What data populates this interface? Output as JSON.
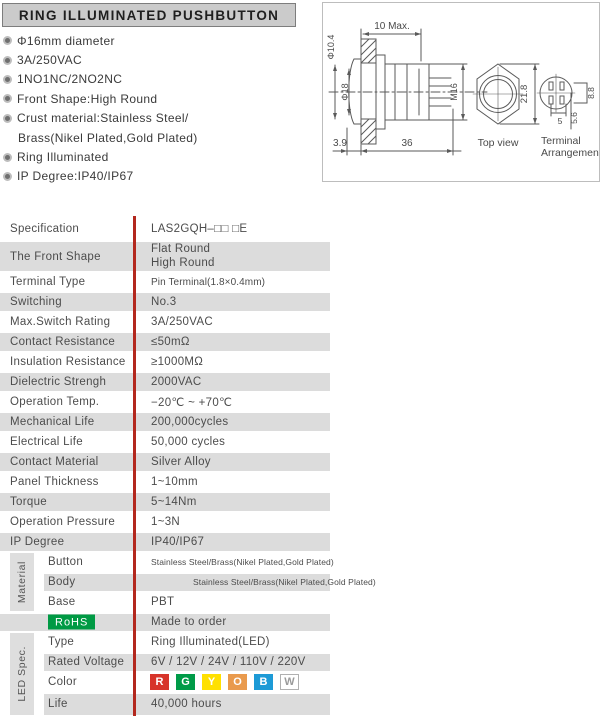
{
  "header": {
    "title": "RING ILLUMINATED PUSHBUTTON"
  },
  "features": {
    "f0": "Φ16mm diameter",
    "f1": "3A/250VAC",
    "f2": "1NO1NC/2NO2NC",
    "f3": "Front Shape:High Round",
    "f4": "Crust material:Stainless Steel/",
    "f4b": "Brass(Nikel Plated,Gold Plated)",
    "f5": "Ring Illuminated",
    "f6": "IP Degree:IP40/IP67"
  },
  "drawing": {
    "dims": {
      "dia_10_4": "Φ10.4",
      "dia_18": "Φ18",
      "panel_max": "10 Max.",
      "thread": "M16",
      "front": "3.9",
      "length": "36",
      "hex": "21.8",
      "term_w": "8.8",
      "term_p": "5.6",
      "term_s": "5"
    },
    "captions": {
      "top_view": "Top view",
      "terminal1": "Terminal",
      "terminal2": "Arrangement"
    }
  },
  "table": {
    "simple_rows": [
      {
        "label": "Specification",
        "value": "LAS2GQH–□□ □E"
      },
      {
        "label": "The Front Shape",
        "value": "Flat Round",
        "value2": "High Round"
      },
      {
        "label": "Terminal Type",
        "value": "Pin Terminal(1.8×0.4mm)"
      },
      {
        "label": "Switching",
        "value": "No.3"
      },
      {
        "label": "Max.Switch Rating",
        "value": "3A/250VAC"
      },
      {
        "label": "Contact Resistance",
        "value": "≤50mΩ"
      },
      {
        "label": "Insulation Resistance",
        "value": "≥1000MΩ"
      },
      {
        "label": "Dielectric Strengh",
        "value": "2000VAC"
      },
      {
        "label": "Operation Temp.",
        "value": "−20℃ ~ +70℃"
      },
      {
        "label": "Mechanical Life",
        "value": "200,000cycles"
      },
      {
        "label": "Electrical Life",
        "value": "50,000 cycles"
      },
      {
        "label": "Contact Material",
        "value": "Silver Alloy"
      },
      {
        "label": "Panel Thickness",
        "value": "1~10mm"
      },
      {
        "label": "Torque",
        "value": "5~14Nm"
      },
      {
        "label": "Operation Pressure",
        "value": "1~3N"
      },
      {
        "label": "IP Degree",
        "value": "IP40/IP67"
      }
    ],
    "material_group": {
      "group_label": "Material",
      "rows": [
        {
          "label": "Button",
          "value": "Stainless Steel/Brass(Nikel Plated,Gold Plated)"
        },
        {
          "label": "Body",
          "value": "Stainless Steel/Brass(Nikel Plated,Gold Plated)"
        },
        {
          "label": "Base",
          "value": "PBT"
        }
      ]
    },
    "rohs_row": {
      "badge": "RoHS",
      "value": "Made to order",
      "badge_color": "#009a44"
    },
    "led_group": {
      "group_label": "LED Spec.",
      "rows": [
        {
          "label": "Type",
          "value": "Ring Illuminated(LED)"
        },
        {
          "label": "Rated Voltage",
          "value": "6V / 12V / 24V / 110V / 220V"
        },
        {
          "label": "Color"
        },
        {
          "label": "Life",
          "value": "40,000 hours"
        }
      ],
      "color_badges": [
        {
          "letter": "R",
          "style": "background:#d7342a;color:#ffffff"
        },
        {
          "letter": "G",
          "style": "background:#009b48;color:#ffffff"
        },
        {
          "letter": "Y",
          "style": "background:#ffe000;color:#ffffff"
        },
        {
          "letter": "O",
          "style": "background:#e99a4d;color:#ffffff"
        },
        {
          "letter": "B",
          "style": "background:#1d9ad6;color:#ffffff"
        },
        {
          "letter": "W",
          "style": "background:#ffffff;color:#9a9a9a;border:1px solid #b0b0b0"
        }
      ]
    },
    "colors": {
      "row_gray": "#dcdcdc",
      "divider_red": "#b3281e",
      "header_gray": "#cbcbcb"
    }
  }
}
